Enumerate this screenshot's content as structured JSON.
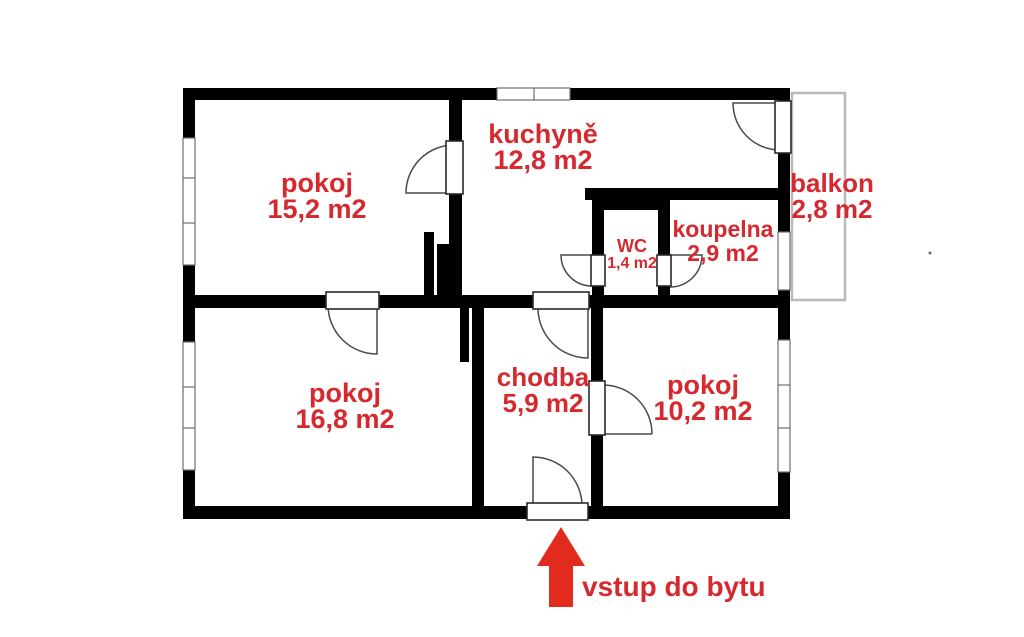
{
  "colors": {
    "label_red": "#d5292f",
    "arrow_red": "#e32b1d",
    "wall_black": "#000000",
    "balcony_gray": "#b9b9b9"
  },
  "rooms": [
    {
      "id": "pokoj-top-left",
      "name": "pokoj",
      "area": "15,2 m2"
    },
    {
      "id": "kuchyne",
      "name": "kuchyně",
      "area": "12,8 m2"
    },
    {
      "id": "balkon",
      "name": "balkon",
      "area": "2,8 m2"
    },
    {
      "id": "koupelna",
      "name": "koupelna",
      "area": "2,9 m2"
    },
    {
      "id": "wc",
      "name": "WC",
      "area": "1,4 m2"
    },
    {
      "id": "pokoj-bottom-left",
      "name": "pokoj",
      "area": "16,8 m2"
    },
    {
      "id": "chodba",
      "name": "chodba",
      "area": "5,9 m2"
    },
    {
      "id": "pokoj-bottom-right",
      "name": "pokoj",
      "area": "10,2 m2"
    }
  ],
  "entrance": {
    "label": "vstup do bytu"
  }
}
